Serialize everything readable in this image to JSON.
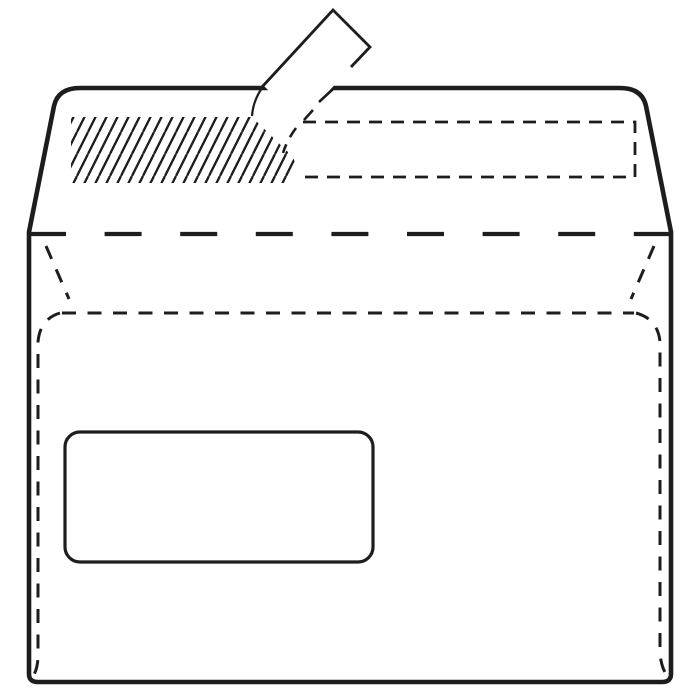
{
  "colors": {
    "background": "#ffffff",
    "line": "#1d1d1b"
  },
  "diagram": {
    "type": "technical-line-illustration",
    "subject": "back of a peel-and-seal window envelope with the sealing strip partially peeled",
    "parts": [
      "envelope-outline",
      "flap-fold-line",
      "adhesive-strip-hatched-area",
      "strip-liner-dashed-outline",
      "peel-tab",
      "peel-curl-marks",
      "bottom-flap-top-edge",
      "left-side-seam",
      "right-side-seam",
      "left-side-flap-edge",
      "right-side-flap-edge",
      "address-window"
    ]
  }
}
